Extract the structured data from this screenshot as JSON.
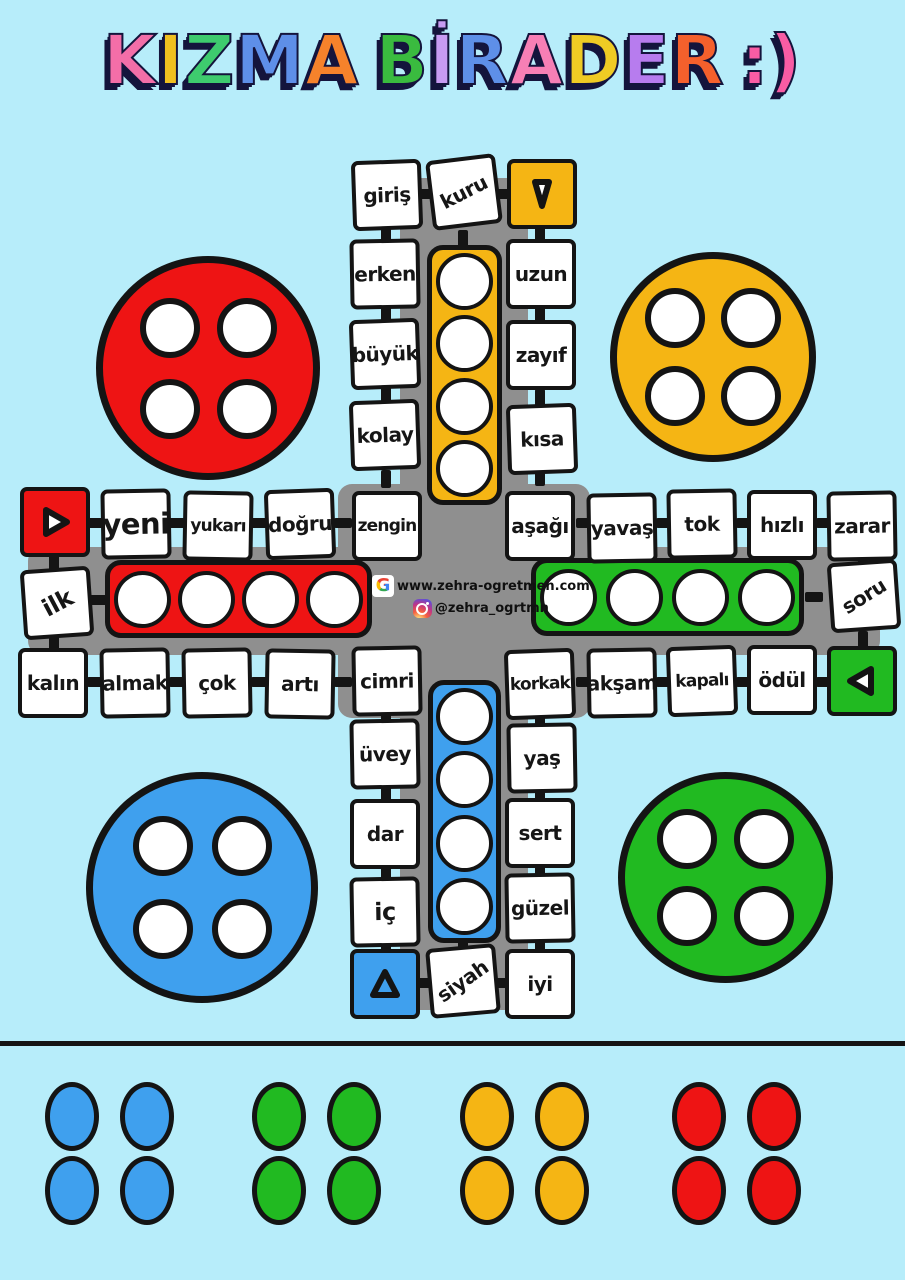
{
  "title": {
    "text": "KIZMA BİRADER :)",
    "shadow_color": "#14143C",
    "letters": [
      {
        "ch": "K",
        "color": "#F36EA8"
      },
      {
        "ch": "I",
        "color": "#F0C020"
      },
      {
        "ch": "Z",
        "color": "#3ECB6E"
      },
      {
        "ch": "M",
        "color": "#5E8FE8"
      },
      {
        "ch": "A",
        "color": "#F6822B"
      },
      {
        "ch": " ",
        "color": ""
      },
      {
        "ch": "B",
        "color": "#3ABB3F"
      },
      {
        "ch": "İ",
        "color": "#C89BF2"
      },
      {
        "ch": "R",
        "color": "#5E8FE8"
      },
      {
        "ch": "A",
        "color": "#F77FB5"
      },
      {
        "ch": "D",
        "color": "#EFCB24"
      },
      {
        "ch": "E",
        "color": "#B77CEE"
      },
      {
        "ch": "R",
        "color": "#F4602C"
      },
      {
        "ch": " ",
        "color": ""
      },
      {
        "ch": ":)",
        "color": "#F85CA4"
      }
    ]
  },
  "board": {
    "colors": {
      "background": "#B7EDFA",
      "track": "#8F8F8F",
      "outline": "#141414",
      "red": "#EE1414",
      "yellow": "#F5B514",
      "green": "#21BA21",
      "blue": "#3FA0EE"
    },
    "cells": {
      "giris": "giriş",
      "kuru": "kuru",
      "uzun": "uzun",
      "erken": "erken",
      "zayif": "zayıf",
      "buyuk": "büyük",
      "kolay": "kolay",
      "kisa": "kısa",
      "yeni": "yeni",
      "yukari": "yukarı",
      "dogru": "doğru",
      "zengin": "zengin",
      "ilk": "ilk",
      "kalin": "kalın",
      "almak": "almak",
      "cok": "çok",
      "arti": "artı",
      "cimri": "cimri",
      "asagi": "aşağı",
      "yavas": "yavaş",
      "tok": "tok",
      "hizli": "hızlı",
      "zarar": "zarar",
      "soru": "soru",
      "korkak": "korkak",
      "aksam": "akşam",
      "kapali": "kapalı",
      "odul": "ödül",
      "uvey": "üvey",
      "yas": "yaş",
      "dar": "dar",
      "sert": "sert",
      "ic": "iç",
      "guzel": "güzel",
      "siyah": "siyah",
      "iyi": "iyi"
    },
    "arrows": {
      "red": {
        "direction": "right"
      },
      "yellow": {
        "direction": "down"
      },
      "green": {
        "direction": "left"
      },
      "blue": {
        "direction": "up"
      }
    },
    "homes": {
      "yellow_circles": 4,
      "red_circles": 4,
      "green_circles": 4,
      "blue_circles": 4
    },
    "corners": {
      "red_circles": 4,
      "yellow_circles": 4,
      "blue_circles": 4,
      "green_circles": 4
    },
    "center": {
      "website": "www.zehra-ogretmen.com",
      "instagram_handle": "@zehra_ogrtmn"
    }
  },
  "pieces": {
    "groups": [
      {
        "color": "blue",
        "count": 4
      },
      {
        "color": "green",
        "count": 4
      },
      {
        "color": "yellow",
        "count": 4
      },
      {
        "color": "red",
        "count": 4
      }
    ]
  }
}
